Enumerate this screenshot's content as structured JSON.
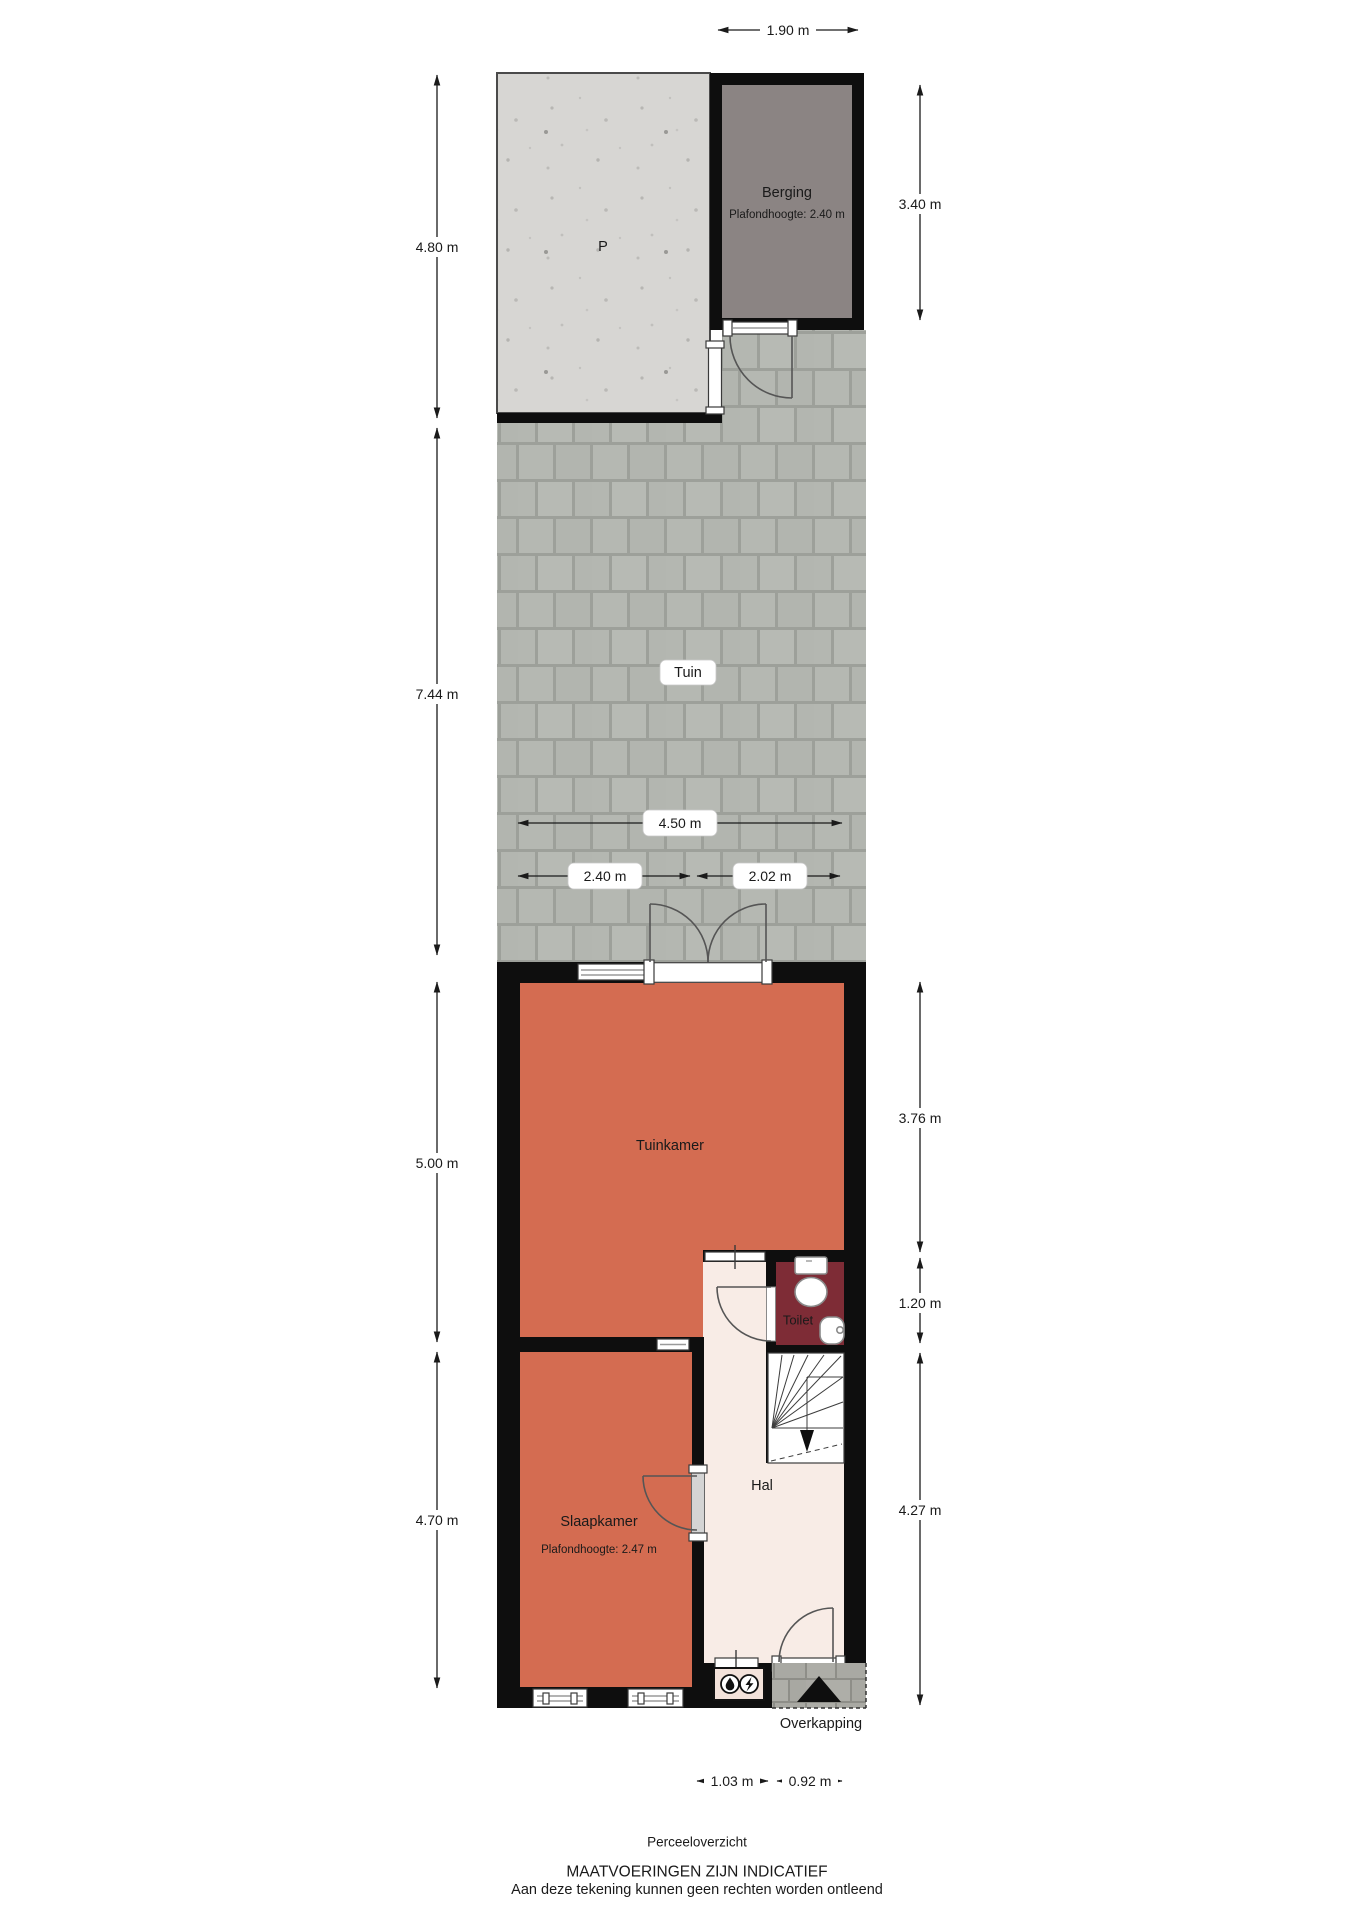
{
  "page": {
    "title": "Perceeloverzicht",
    "disclaimer_line1": "MAATVOERINGEN ZIJN INDICATIEF",
    "disclaimer_line2": "Aan deze tekening kunnen geen rechten worden ontleend"
  },
  "rooms": {
    "parking": {
      "label": "P"
    },
    "berging": {
      "label": "Berging",
      "ceiling_height": "Plafondhoogte: 2.40 m"
    },
    "tuin": {
      "label": "Tuin"
    },
    "tuinkamer": {
      "label": "Tuinkamer"
    },
    "toilet": {
      "label": "Toilet"
    },
    "hal": {
      "label": "Hal"
    },
    "slaapkamer": {
      "label": "Slaapkamer",
      "ceiling_height": "Plafondhoogte: 2.47 m"
    },
    "overkapping": {
      "label": "Overkapping"
    }
  },
  "dimensions": {
    "top_width": "1.90 m",
    "left": [
      "4.80 m",
      "7.44 m",
      "5.00 m",
      "4.70 m"
    ],
    "right": [
      "3.40 m",
      "3.76 m",
      "1.20 m",
      "4.27 m"
    ],
    "tuin_width": "4.50 m",
    "tuin_left": "2.40 m",
    "tuin_right": "2.02 m",
    "bottom_left": "1.03 m",
    "bottom_right": "0.92 m"
  },
  "colors": {
    "wall": "#0e0e0e",
    "room_orange": "#d46c51",
    "toilet_red": "#7e2c36",
    "hal_pink": "#f8ece6",
    "berging_gray": "#8b8483",
    "meterkast_pink": "#f3e2da"
  }
}
